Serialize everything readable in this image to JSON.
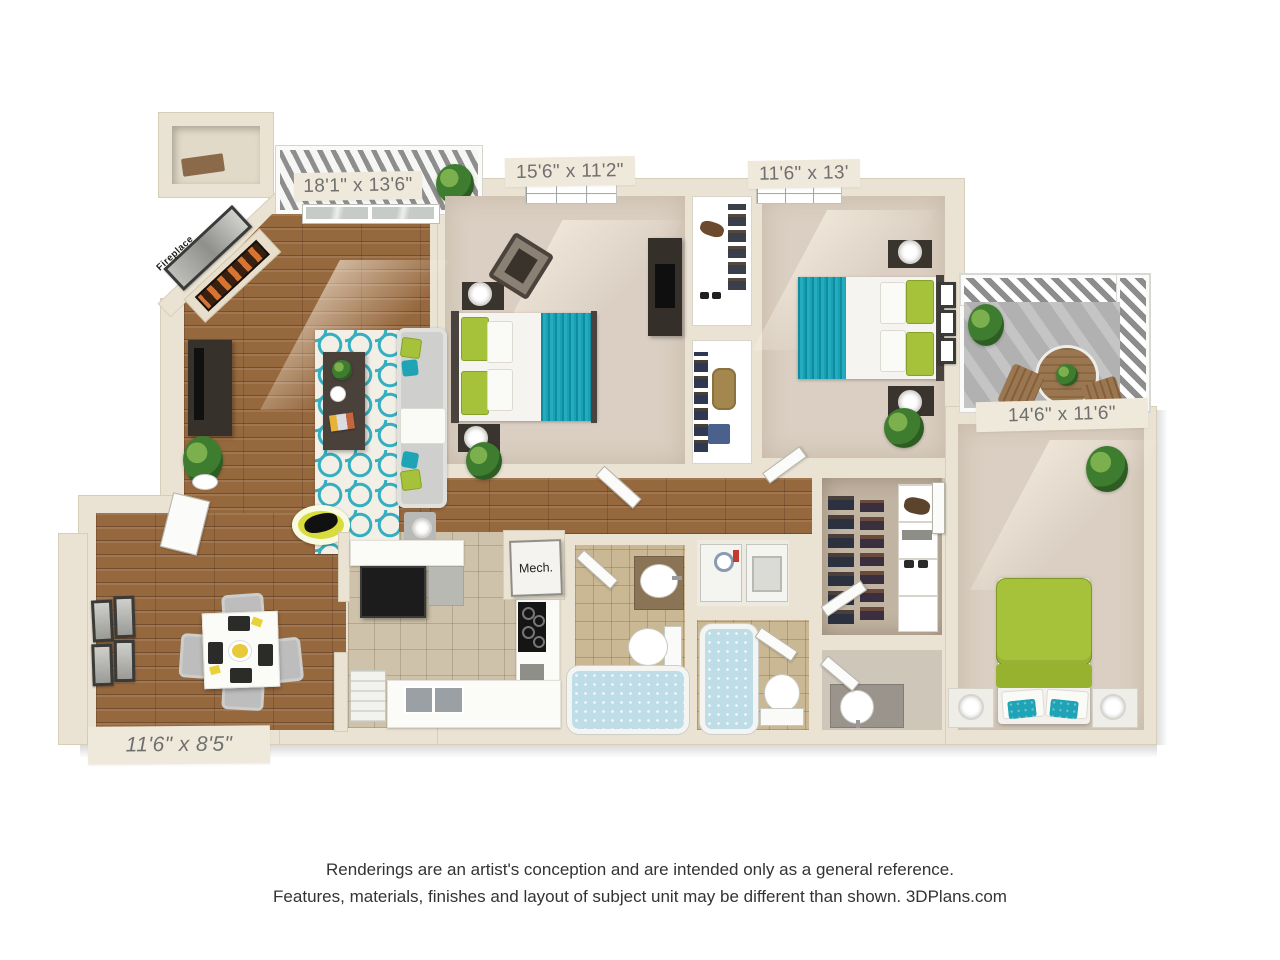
{
  "labels": {
    "living_room_dims": "18'1\" x 13'6\"",
    "bedroom1_dims": "15'6\" x 11'2\"",
    "bedroom2_dims": "11'6\" x 13'",
    "master_bedroom_dims": "14'6\" x 11'6\"",
    "dining_room_dims": "11'6\" x 8'5\"",
    "mech_closet": "Mech.",
    "fireplace": "Fireplace"
  },
  "disclaimer": {
    "line1": "Renderings are an artist's conception and are intended only as a general reference.",
    "line2": "Features, materials, finishes and layout of subject unit may be different than shown. 3DPlans.com"
  },
  "colors": {
    "wall": "#EAE3D3",
    "carpet": "#DACFC2",
    "wood": "#96683E",
    "tile_kitchen": "#CEC2AA",
    "tile_bath": "#C9B893",
    "balcony_concrete": "#B1B1B1",
    "teal": "#1FA4B6",
    "green": "#A6C23A",
    "accent_yellow": "#D8DC3C"
  }
}
